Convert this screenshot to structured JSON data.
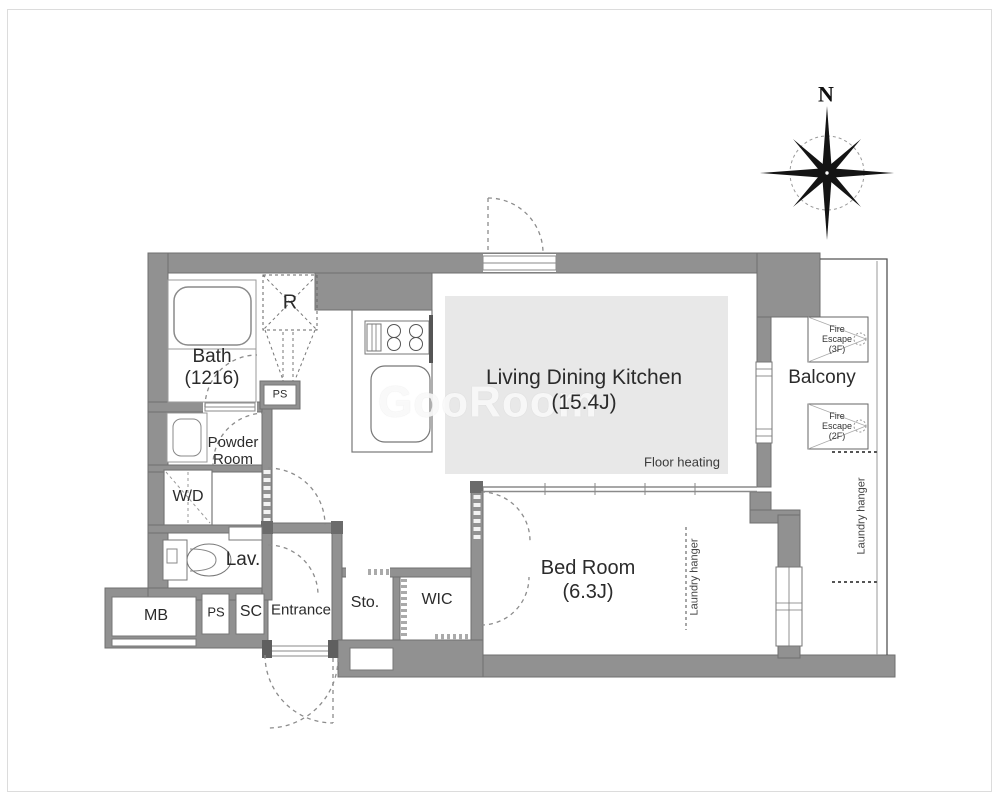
{
  "rooms": {
    "bath": "Bath\n(1216)",
    "range": "R",
    "ps_upper": "PS",
    "powder": "Powder\nRoom",
    "washer_dryer": "W/D",
    "lavatory": "Lav.",
    "meter_box": "MB",
    "ps_lower": "PS",
    "shoe_cabinet": "SC",
    "entrance": "Entrance",
    "storage": "Sto.",
    "walk_in_closet": "WIC",
    "ldk": "Living Dining Kitchen\n(15.4J)",
    "floor_heating": "Floor heating",
    "bedroom": "Bed Room\n(6.3J)",
    "bedroom_laundry_hanger": "Laundry hanger",
    "balcony": "Balcony",
    "balcony_laundry_hanger": "Laundry hanger",
    "fire_escape_upper": "Fire\nEscape\n(3F)",
    "fire_escape_lower": "Fire\nEscape\n(2F)"
  },
  "compass": {
    "north": "N"
  },
  "watermark": "GooRoom",
  "colors": {
    "wall": "#919191",
    "wall_edge": "#6f6f6f",
    "floor_heating_fill": "#e8e8e8",
    "text": "#2b2b2b"
  }
}
